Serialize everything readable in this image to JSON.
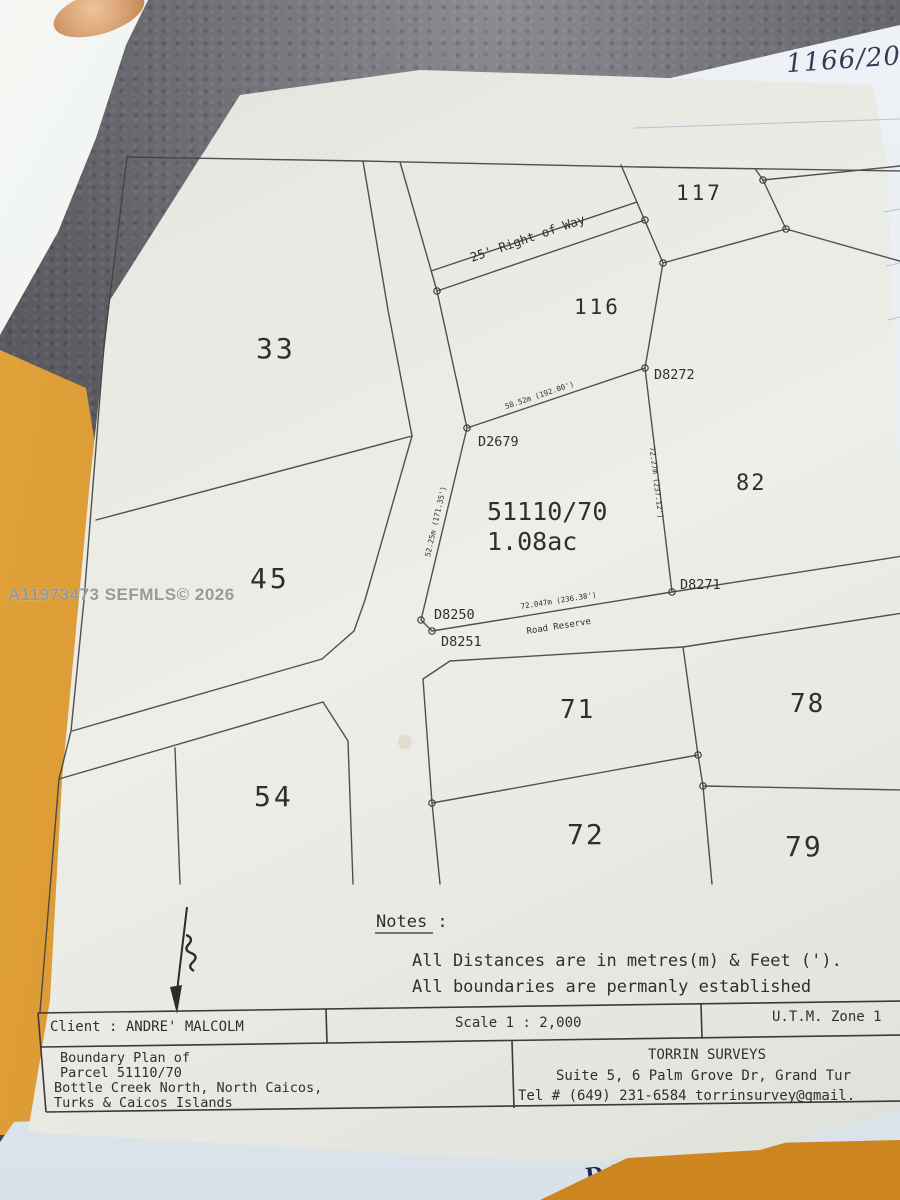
{
  "photo": {
    "ref_number": "1166/2022",
    "watermark": "A11973473  SEFMLS© 2026",
    "date_label": "DATE:"
  },
  "plan": {
    "parcels": {
      "p33": "33",
      "p45": "45",
      "p54": "54",
      "p116": "116",
      "p117": "117",
      "p82": "82",
      "p71": "71",
      "p78": "78",
      "p72": "72",
      "p79": "79"
    },
    "subject": {
      "id": "51110/70",
      "area": "1.08ac"
    },
    "roads": {
      "right_of_way": "25' Right of Way",
      "road_reserve": "Road Reserve"
    },
    "points": {
      "d2679": "D2679",
      "d8272": "D8272",
      "d8271": "D8271",
      "d8250": "D8250",
      "d8251": "D8251"
    },
    "measurements": {
      "north_boundary": "58.52m (192.00')",
      "east_boundary": "72.27m (237.12')",
      "west_boundary": "52.25m (171.35')",
      "south_boundary": "72.047m (236.38')"
    },
    "notes": {
      "title": "Notes :",
      "line1": "All Distances are in metres(m) & Feet (').",
      "line2": "All boundaries are permanly established"
    },
    "info_row": {
      "client": "Client : ANDRE' MALCOLM",
      "scale": "Scale 1 : 2,000",
      "utm_zone": "U.T.M. Zone 1"
    },
    "title_block": {
      "line1": "Boundary Plan of",
      "line2": "Parcel  51110/70",
      "line3": "Bottle Creek North, North Caicos,",
      "line4": "Turks & Caicos Islands"
    },
    "surveyor": {
      "name": "TORRIN SURVEYS",
      "address": "Suite 5, 6 Palm Grove Dr,   Grand Tur",
      "contact": "Tel # (649) 231-6584  torrinsurvey@gmail."
    }
  }
}
